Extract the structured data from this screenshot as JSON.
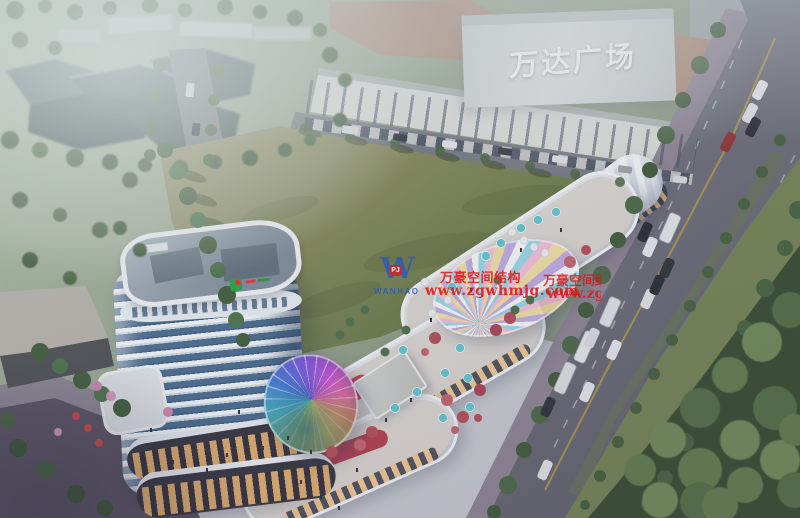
{
  "meta": {
    "description": "Aerial dusk architectural rendering of a mixed-use commercial complex with a curved high-rise tower, rainbow glass dome canopies, terraced retail streets, a large green field, and a tree-lined boulevard beside Wanda Plaza",
    "image_type": "architectural-rendering"
  },
  "signs": {
    "mall_sign": "万达广场"
  },
  "watermark": {
    "logo_letter": "W",
    "logo_badge": "PJ",
    "logo_name": "WANHAO",
    "title": "万豪空间结构",
    "url": "www.zgwhmjg.com",
    "fragment_title": "万豪空间结构",
    "fragment_url": "www.zgwhmjg",
    "red": "#de1212",
    "blue": "#2a5ab4"
  },
  "palette": {
    "field_green": "#7e8454",
    "park_green": "#31482b",
    "road_gray": "#6f717b",
    "sidewalk_pink": "#8b8290",
    "tower_glass": "#45688a",
    "tower_band_white": "#f3f7f9",
    "accent_red_wall": "#c04050",
    "umbrella_teal": "#5ec5cb",
    "hall_white": "#f4f6f8",
    "wanda_roof_tan": "#ab8a76",
    "haze": "#e4eae6"
  }
}
